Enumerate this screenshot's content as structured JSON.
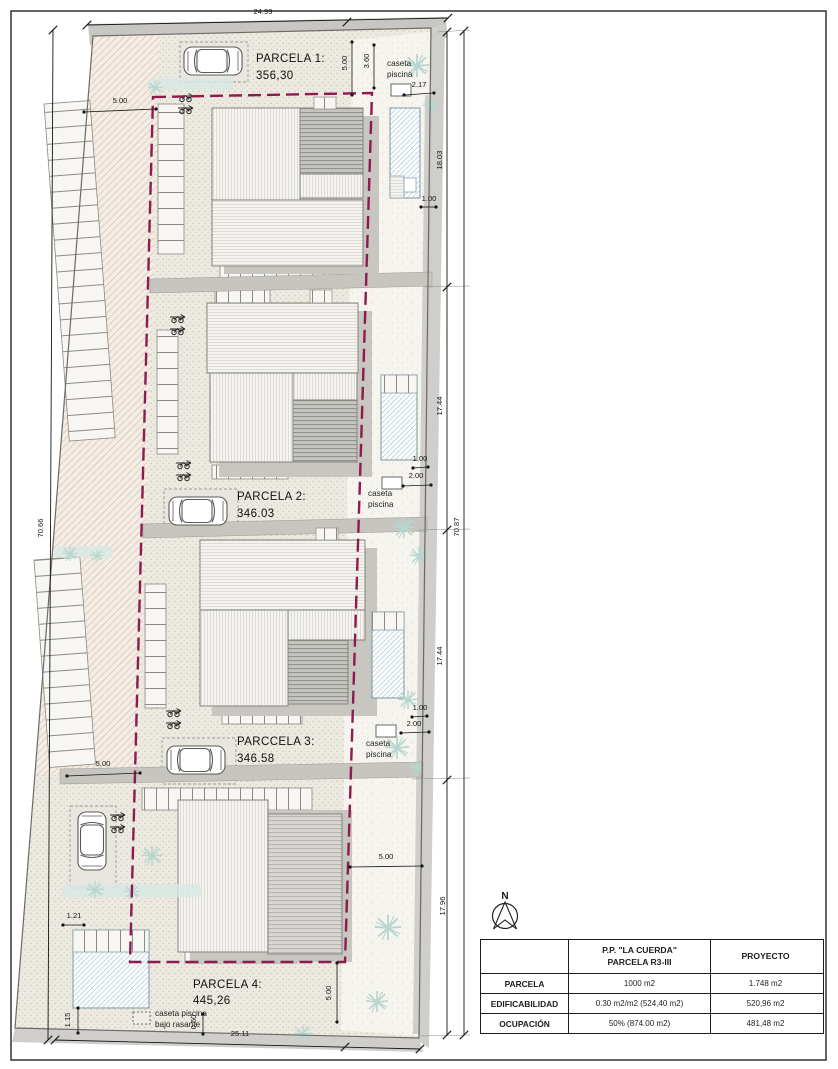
{
  "colors": {
    "setback_line": "#8c1b4f",
    "plot_ground": "#ece9e0",
    "street_band": "#cfcecb",
    "pool_water": "#c2d6de",
    "vegetation": "#b6d6cf",
    "house_dark_hatch": "#c6c5c0"
  },
  "plan": {
    "north_label": "N",
    "parcels": [
      {
        "name": "PARCELA 1:",
        "area": "356,30"
      },
      {
        "name": "PARCELA 2:",
        "area": "346.03"
      },
      {
        "name": "PARCCELA 3:",
        "area": "346.58"
      },
      {
        "name": "PARCELA 4:",
        "area": "445,26"
      }
    ],
    "caseta": {
      "line1": "caseta",
      "line2": "piscina"
    },
    "caseta_bajo": {
      "line1": "caseta piscina",
      "line2": "bajo rasante"
    },
    "dims": {
      "top": "24.99",
      "bottom": "25.11",
      "left": "70.66",
      "right": "70.87",
      "p1": "18.03",
      "p2": "17.44",
      "p3": "17.44",
      "p4": "17.96",
      "d500": "5.00",
      "d360": "3.60",
      "d217": "2.17",
      "d100": "1.00",
      "d200": "2.00",
      "d121": "1.21",
      "d115": "1.15",
      "d050": "0.50"
    }
  },
  "summary_table": {
    "header_plan_line1": "P.P. \"LA CUERDA\"",
    "header_plan_line2": "PARCELA R3-III",
    "header_project": "PROYECTO",
    "rows": [
      {
        "label": "PARCELA",
        "plan": "1000 m2",
        "project": "1.748 m2"
      },
      {
        "label": "EDIFICABILIDAD",
        "plan": "0.30 m2/m2  (524,40 m2)",
        "project": "520,96 m2"
      },
      {
        "label": "OCUPACIÓN",
        "plan": "50%  (874.00 m2)",
        "project": "481,48 m2"
      }
    ]
  }
}
